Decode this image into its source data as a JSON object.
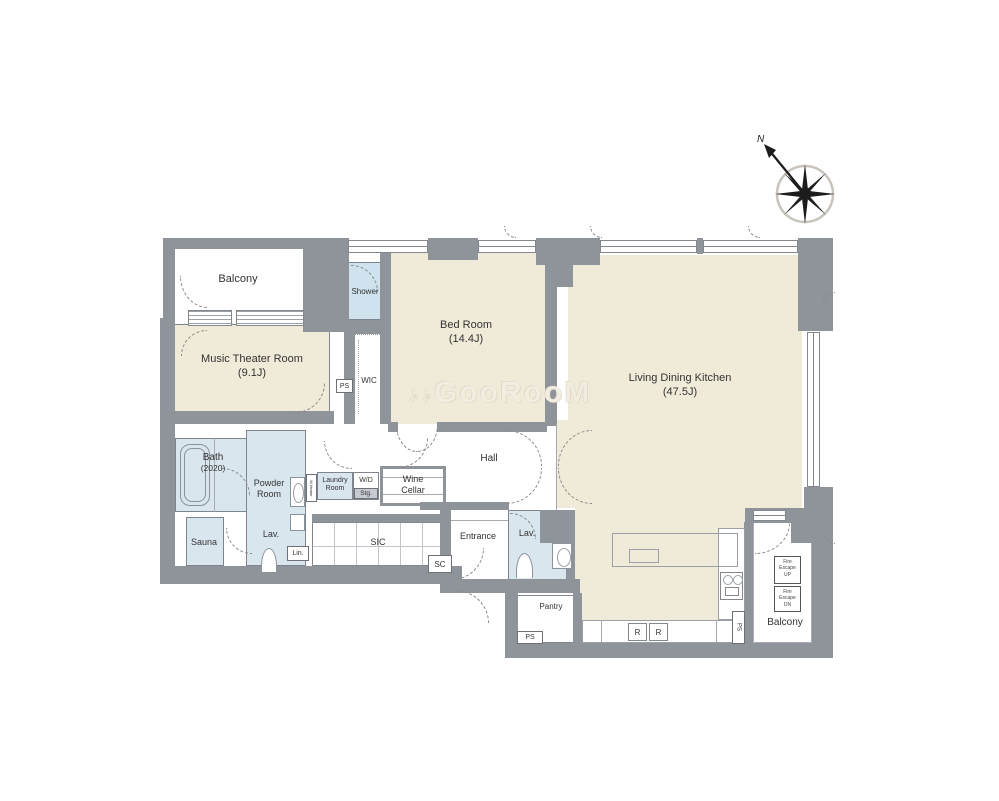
{
  "colors": {
    "wall": "#8f939a",
    "floor": "#f0ead9",
    "wet_area": "#d9e6ee",
    "background": "#ffffff"
  },
  "watermark": {
    "mark": "♪♪",
    "text": "GooRooM"
  },
  "compass": {
    "north": "N"
  },
  "rooms": {
    "balcony_north": {
      "name": "Balcony"
    },
    "music_theater": {
      "name": "Music Theater Room",
      "size": "(9.1J)"
    },
    "shower": {
      "name": "Shower"
    },
    "wic": {
      "name": "WIC"
    },
    "bedroom": {
      "name": "Bed Room",
      "size": "(14.4J)"
    },
    "ldk": {
      "name": "Living Dining Kitchen",
      "size": "(47.5J)"
    },
    "bath": {
      "name": "Bath",
      "size": "(2020)"
    },
    "powder_room": {
      "line1": "Powder",
      "line2": "Room"
    },
    "sauna": {
      "name": "Sauna"
    },
    "lavatory_west": {
      "name": "Lav."
    },
    "laundry": {
      "line1": "Laundry",
      "line2": "Room"
    },
    "wd_storage": {
      "name": "W/D",
      "sub": "Stg."
    },
    "wine_cellar": {
      "line1": "Wine",
      "line2": "Cellar"
    },
    "hall": {
      "name": "Hall"
    },
    "sic": {
      "name": "SIC"
    },
    "entrance": {
      "name": "Entrance"
    },
    "lavatory_east": {
      "name": "Lav."
    },
    "pantry": {
      "name": "Pantry"
    },
    "balcony_south": {
      "name": "Balcony"
    }
  },
  "labels": {
    "ps": "PS",
    "sc": "SC",
    "lin": "Lin.",
    "r": "R",
    "heater": "W.Heater",
    "fire_escape_up": {
      "l1": "Fire",
      "l2": "Escape",
      "l3": "UP"
    },
    "fire_escape_dn": {
      "l1": "Fire",
      "l2": "Escape",
      "l3": "DN"
    }
  }
}
